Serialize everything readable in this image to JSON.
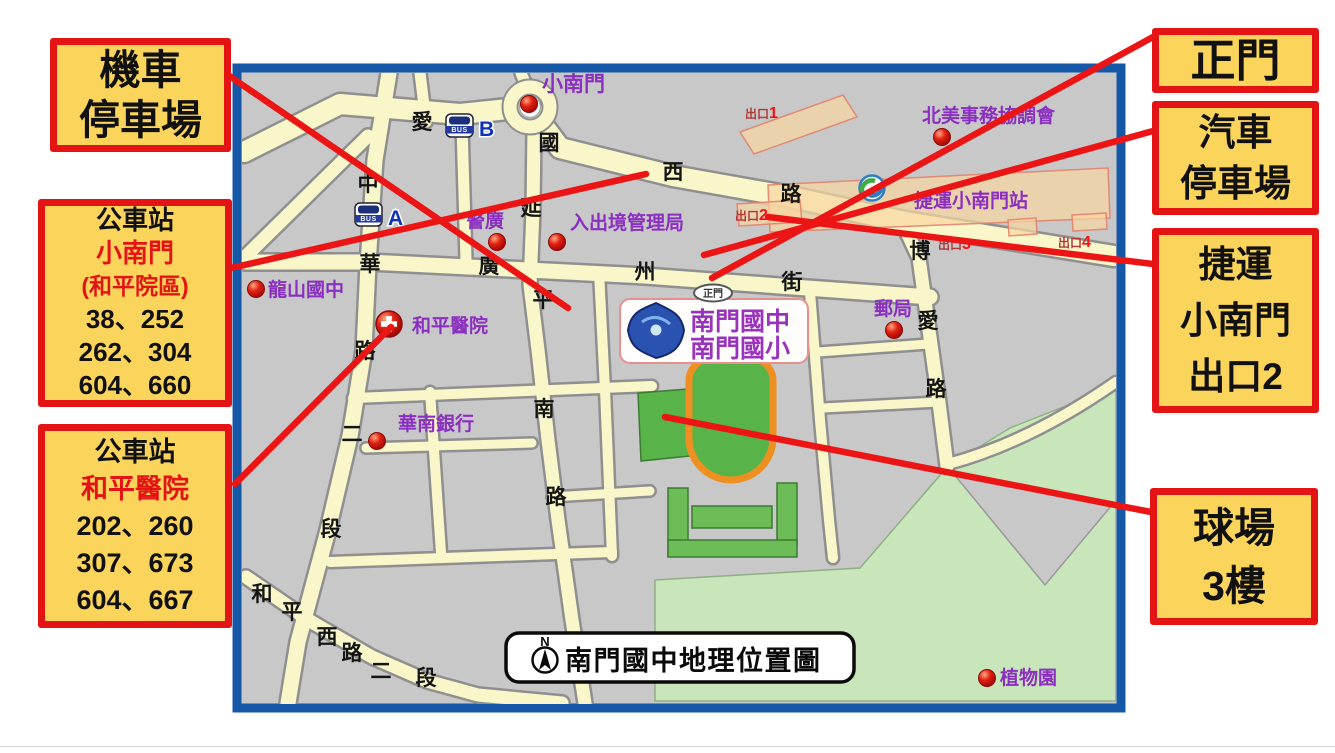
{
  "title_box": {
    "text": "南門國中地理位置圖",
    "compass_n": "N"
  },
  "callouts": {
    "motorcycle_parking": {
      "lines": [
        "機車",
        "停車場"
      ]
    },
    "bus_stop_xiaonanmen": {
      "header": "公車站",
      "stop_name": "小南門",
      "stop_name_sub": "(和平院區)",
      "routes": [
        "38、252",
        "262、304",
        "604、660"
      ]
    },
    "bus_stop_heping_hospital": {
      "header": "公車站",
      "stop_name": "和平醫院",
      "routes": [
        "202、260",
        "307、673",
        "604、667"
      ]
    },
    "main_gate": {
      "lines": [
        "正門"
      ]
    },
    "car_parking": {
      "lines": [
        "汽車",
        "停車場"
      ]
    },
    "mrt_exit2": {
      "lines": [
        "捷運",
        "小南門",
        "出口2"
      ]
    },
    "ball_court": {
      "lines": [
        "球場",
        "3樓"
      ]
    }
  },
  "map": {
    "school_sign": {
      "line1": "南門國中",
      "line2": "南門國小"
    },
    "gate_label": "正門",
    "station_label": "捷運小南門站",
    "streets": [
      {
        "name": "aiguo-west-road",
        "chars": [
          {
            "c": "愛",
            "x": 422,
            "y": 122
          },
          {
            "c": "國",
            "x": 549,
            "y": 143
          },
          {
            "c": "西",
            "x": 673,
            "y": 172
          },
          {
            "c": "路",
            "x": 791,
            "y": 194
          }
        ]
      },
      {
        "name": "zhonghua-road",
        "chars": [
          {
            "c": "中",
            "x": 368,
            "y": 184
          },
          {
            "c": "華",
            "x": 370,
            "y": 264
          },
          {
            "c": "路",
            "x": 365,
            "y": 351
          },
          {
            "c": "二",
            "x": 352,
            "y": 434
          },
          {
            "c": "段",
            "x": 331,
            "y": 529
          }
        ]
      },
      {
        "name": "yanping-south-road",
        "chars": [
          {
            "c": "延",
            "x": 531,
            "y": 208
          },
          {
            "c": "平",
            "x": 543,
            "y": 300
          },
          {
            "c": "南",
            "x": 544,
            "y": 409
          },
          {
            "c": "路",
            "x": 556,
            "y": 497
          }
        ]
      },
      {
        "name": "guangzhou-street",
        "chars": [
          {
            "c": "廣",
            "x": 489,
            "y": 266
          },
          {
            "c": "州",
            "x": 645,
            "y": 272
          },
          {
            "c": "街",
            "x": 792,
            "y": 282
          }
        ]
      },
      {
        "name": "boai-road",
        "chars": [
          {
            "c": "博",
            "x": 920,
            "y": 251
          },
          {
            "c": "愛",
            "x": 928,
            "y": 321
          },
          {
            "c": "路",
            "x": 936,
            "y": 389
          }
        ]
      },
      {
        "name": "hepingxi-road",
        "chars": [
          {
            "c": "和",
            "x": 262,
            "y": 594
          },
          {
            "c": "平",
            "x": 292,
            "y": 612
          },
          {
            "c": "西",
            "x": 327,
            "y": 637
          },
          {
            "c": "路",
            "x": 352,
            "y": 653
          },
          {
            "c": "二",
            "x": 381,
            "y": 671
          },
          {
            "c": "段",
            "x": 426,
            "y": 678
          }
        ]
      }
    ],
    "landmarks": [
      {
        "label": "小南門",
        "lx": 542,
        "ly": 91,
        "marker": "dot",
        "mx": 529,
        "my": 104,
        "big": true
      },
      {
        "label": "警廣",
        "lx": 466,
        "ly": 227,
        "marker": "dot",
        "mx": 497,
        "my": 242
      },
      {
        "label": "入出境管理局",
        "lx": 570,
        "ly": 229,
        "marker": "dot",
        "mx": 557,
        "my": 242
      },
      {
        "label": "龍山國中",
        "lx": 268,
        "ly": 296,
        "marker": "dot",
        "mx": 256,
        "my": 289
      },
      {
        "label": "和平醫院",
        "lx": 412,
        "ly": 332,
        "marker": "cross",
        "mx": 389,
        "my": 324
      },
      {
        "label": "北美事務協調會",
        "lx": 922,
        "ly": 122,
        "marker": "dot",
        "mx": 942,
        "my": 137
      },
      {
        "label": "郵局",
        "lx": 874,
        "ly": 315,
        "marker": "dot",
        "mx": 894,
        "my": 330
      },
      {
        "label": "華南銀行",
        "lx": 398,
        "ly": 430,
        "marker": "dot",
        "mx": 377,
        "my": 441
      },
      {
        "label": "植物園",
        "lx": 1000,
        "ly": 684,
        "marker": "dot",
        "mx": 987,
        "my": 678
      }
    ],
    "exits": [
      {
        "prefix": "出口",
        "num": "1",
        "x": 745,
        "y": 118
      },
      {
        "prefix": "出口",
        "num": "2",
        "x": 735,
        "y": 220
      },
      {
        "prefix": "出口",
        "num": "3",
        "x": 938,
        "y": 249
      },
      {
        "prefix": "出口",
        "num": "4",
        "x": 1058,
        "y": 247
      }
    ],
    "bus_stops": [
      {
        "word": "BUS",
        "letter": "A",
        "x": 355,
        "y": 203
      },
      {
        "word": "BUS",
        "letter": "B",
        "x": 446,
        "y": 114
      }
    ],
    "colors": {
      "box_fill": "#FBD45C",
      "box_border": "#E51414",
      "map_border": "#1558A8",
      "road_fill": "#F9F6C9",
      "road_casing": "#8F8F8F",
      "block_gray": "#C8C8C8",
      "park_green": "#C8E6BA",
      "field_green": "#58B348",
      "building_green": "#6CBD58",
      "track_orange": "#EE8F21",
      "connector_red": "#EC1515",
      "label_purple": "#8B2FC0"
    }
  },
  "connectors": [
    {
      "name": "line-motorcycle-parking",
      "pts": [
        228,
        75,
        568,
        308
      ]
    },
    {
      "name": "line-bus-stop-xiaonanmen",
      "pts": [
        231,
        268,
        646,
        174
      ]
    },
    {
      "name": "line-bus-stop-heping-hospital",
      "pts": [
        235,
        484,
        391,
        327
      ]
    },
    {
      "name": "line-main-gate",
      "pts": [
        1153,
        37,
        712,
        278
      ]
    },
    {
      "name": "line-car-parking",
      "pts": [
        1153,
        131,
        704,
        255
      ]
    },
    {
      "name": "line-mrt-exit2",
      "pts": [
        1153,
        264,
        768,
        217
      ]
    },
    {
      "name": "line-ball-court",
      "pts": [
        1151,
        512,
        665,
        417
      ]
    }
  ]
}
